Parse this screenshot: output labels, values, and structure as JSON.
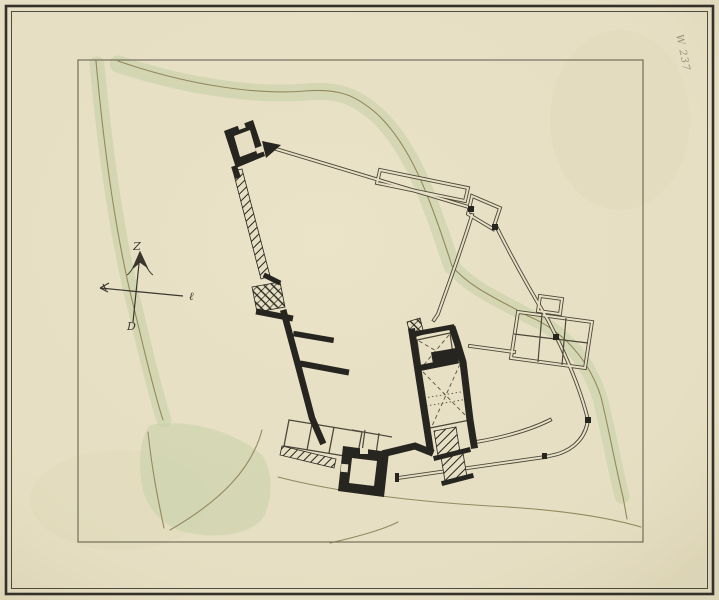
{
  "sheet": {
    "annotation": "W 237",
    "compass": {
      "north": "Z",
      "east": "ℓ",
      "south": "D"
    }
  },
  "colors": {
    "paper": "#e7dfc3",
    "paper-shade": "#dcd3b2",
    "frame": "#33312a",
    "border": "#6b6452",
    "ink": "#26251f",
    "thin-ink": "#4c473a",
    "contour": "#93895f",
    "green": "#c4cfa5",
    "note": "#8d8374"
  }
}
